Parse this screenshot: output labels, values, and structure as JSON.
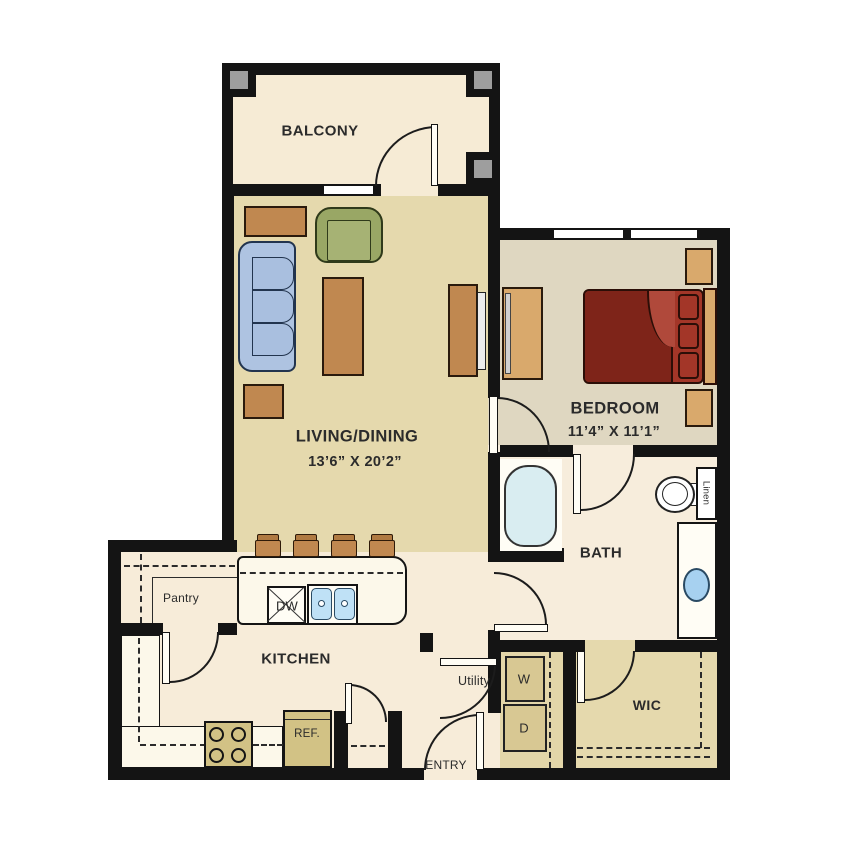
{
  "labels": {
    "balcony": "BALCONY",
    "living_dining": "LIVING/DINING",
    "living_dims": "13’6” X 20’2”",
    "bedroom": "BEDROOM",
    "bedroom_dims": "11’4” X 11’1”",
    "bath": "BATH",
    "kitchen": "KITCHEN",
    "wic": "WIC",
    "pantry": "Pantry",
    "utility": "Utility",
    "entry": "ENTRY",
    "washer": "W",
    "dryer": "D",
    "dishwasher": "DW",
    "refrigerator": "REF.",
    "linen": "Linen"
  },
  "palette": {
    "wall": "#141414",
    "white": "#FFFDF5",
    "balcony_floor": "#F6EBD5",
    "living_floor": "#E5D9AD",
    "bedroom_floor": "#DFD7C1",
    "bath_floor": "#F7EDDC",
    "kitchen_floor": "#F7ECD9",
    "wic_floor": "#E5D9AD",
    "utility_floor": "#E3D6A9",
    "counter": "#FCF8EA",
    "appliance": "#D2C285",
    "wood": "#C08850",
    "wood_light": "#D9A96C",
    "sofa_blue": "#AEC3E1",
    "cushion_blue": "#A9BFDF",
    "chair_green": "#99A765",
    "seat_green": "#A6B274",
    "bed_dark": "#7E2419",
    "bed_mid": "#A33628",
    "bed_light": "#B0493B",
    "tub_blue": "#D9EDF1",
    "sink_blue": "#BFE1F6",
    "vanity_sink_blue": "#A7D1F0",
    "pillar_gray": "#9E9E9E"
  }
}
